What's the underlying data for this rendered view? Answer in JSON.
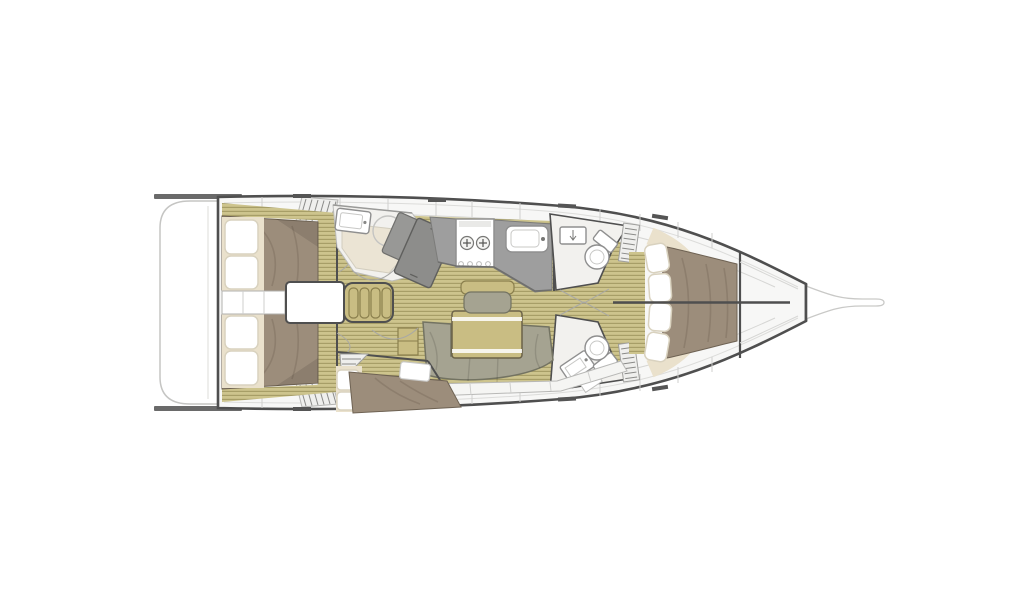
{
  "meta": {
    "view": "sailboat-interior-deck-plan",
    "canvas_width": 1024,
    "canvas_height": 600,
    "background": "#ffffff"
  },
  "palette": {
    "hull_outline": "#4f4f4f",
    "deck": "#f7f7f6",
    "deck_line": "#d6d6d4",
    "platform_line": "#c5c5c3",
    "floor_light": "#cdc48d",
    "floor_dark": "#a79e67",
    "mattress": "#9c8d7b",
    "mattress_edge": "#6e6253",
    "pillow": "#ffffff",
    "pillow_edge": "#d9d2bf",
    "cream": "#eae1cc",
    "sofa": "#a5a391",
    "sofa_edge": "#737362",
    "khaki": "#c9bd83",
    "khaki_edge": "#8a7f4d",
    "counter": "#9e9e9e",
    "wardrobe": "#8d8d8b",
    "wardrobe_small": "#989896",
    "head_floor": "#f2f1ee",
    "shower_floor": "#ebe4d4",
    "hatch_fill": "#efefed",
    "locker_fill": "#f5f5f3",
    "stern_bar": "#6a6a6a",
    "cleat": "#555555",
    "white_box": "#ffffff"
  }
}
